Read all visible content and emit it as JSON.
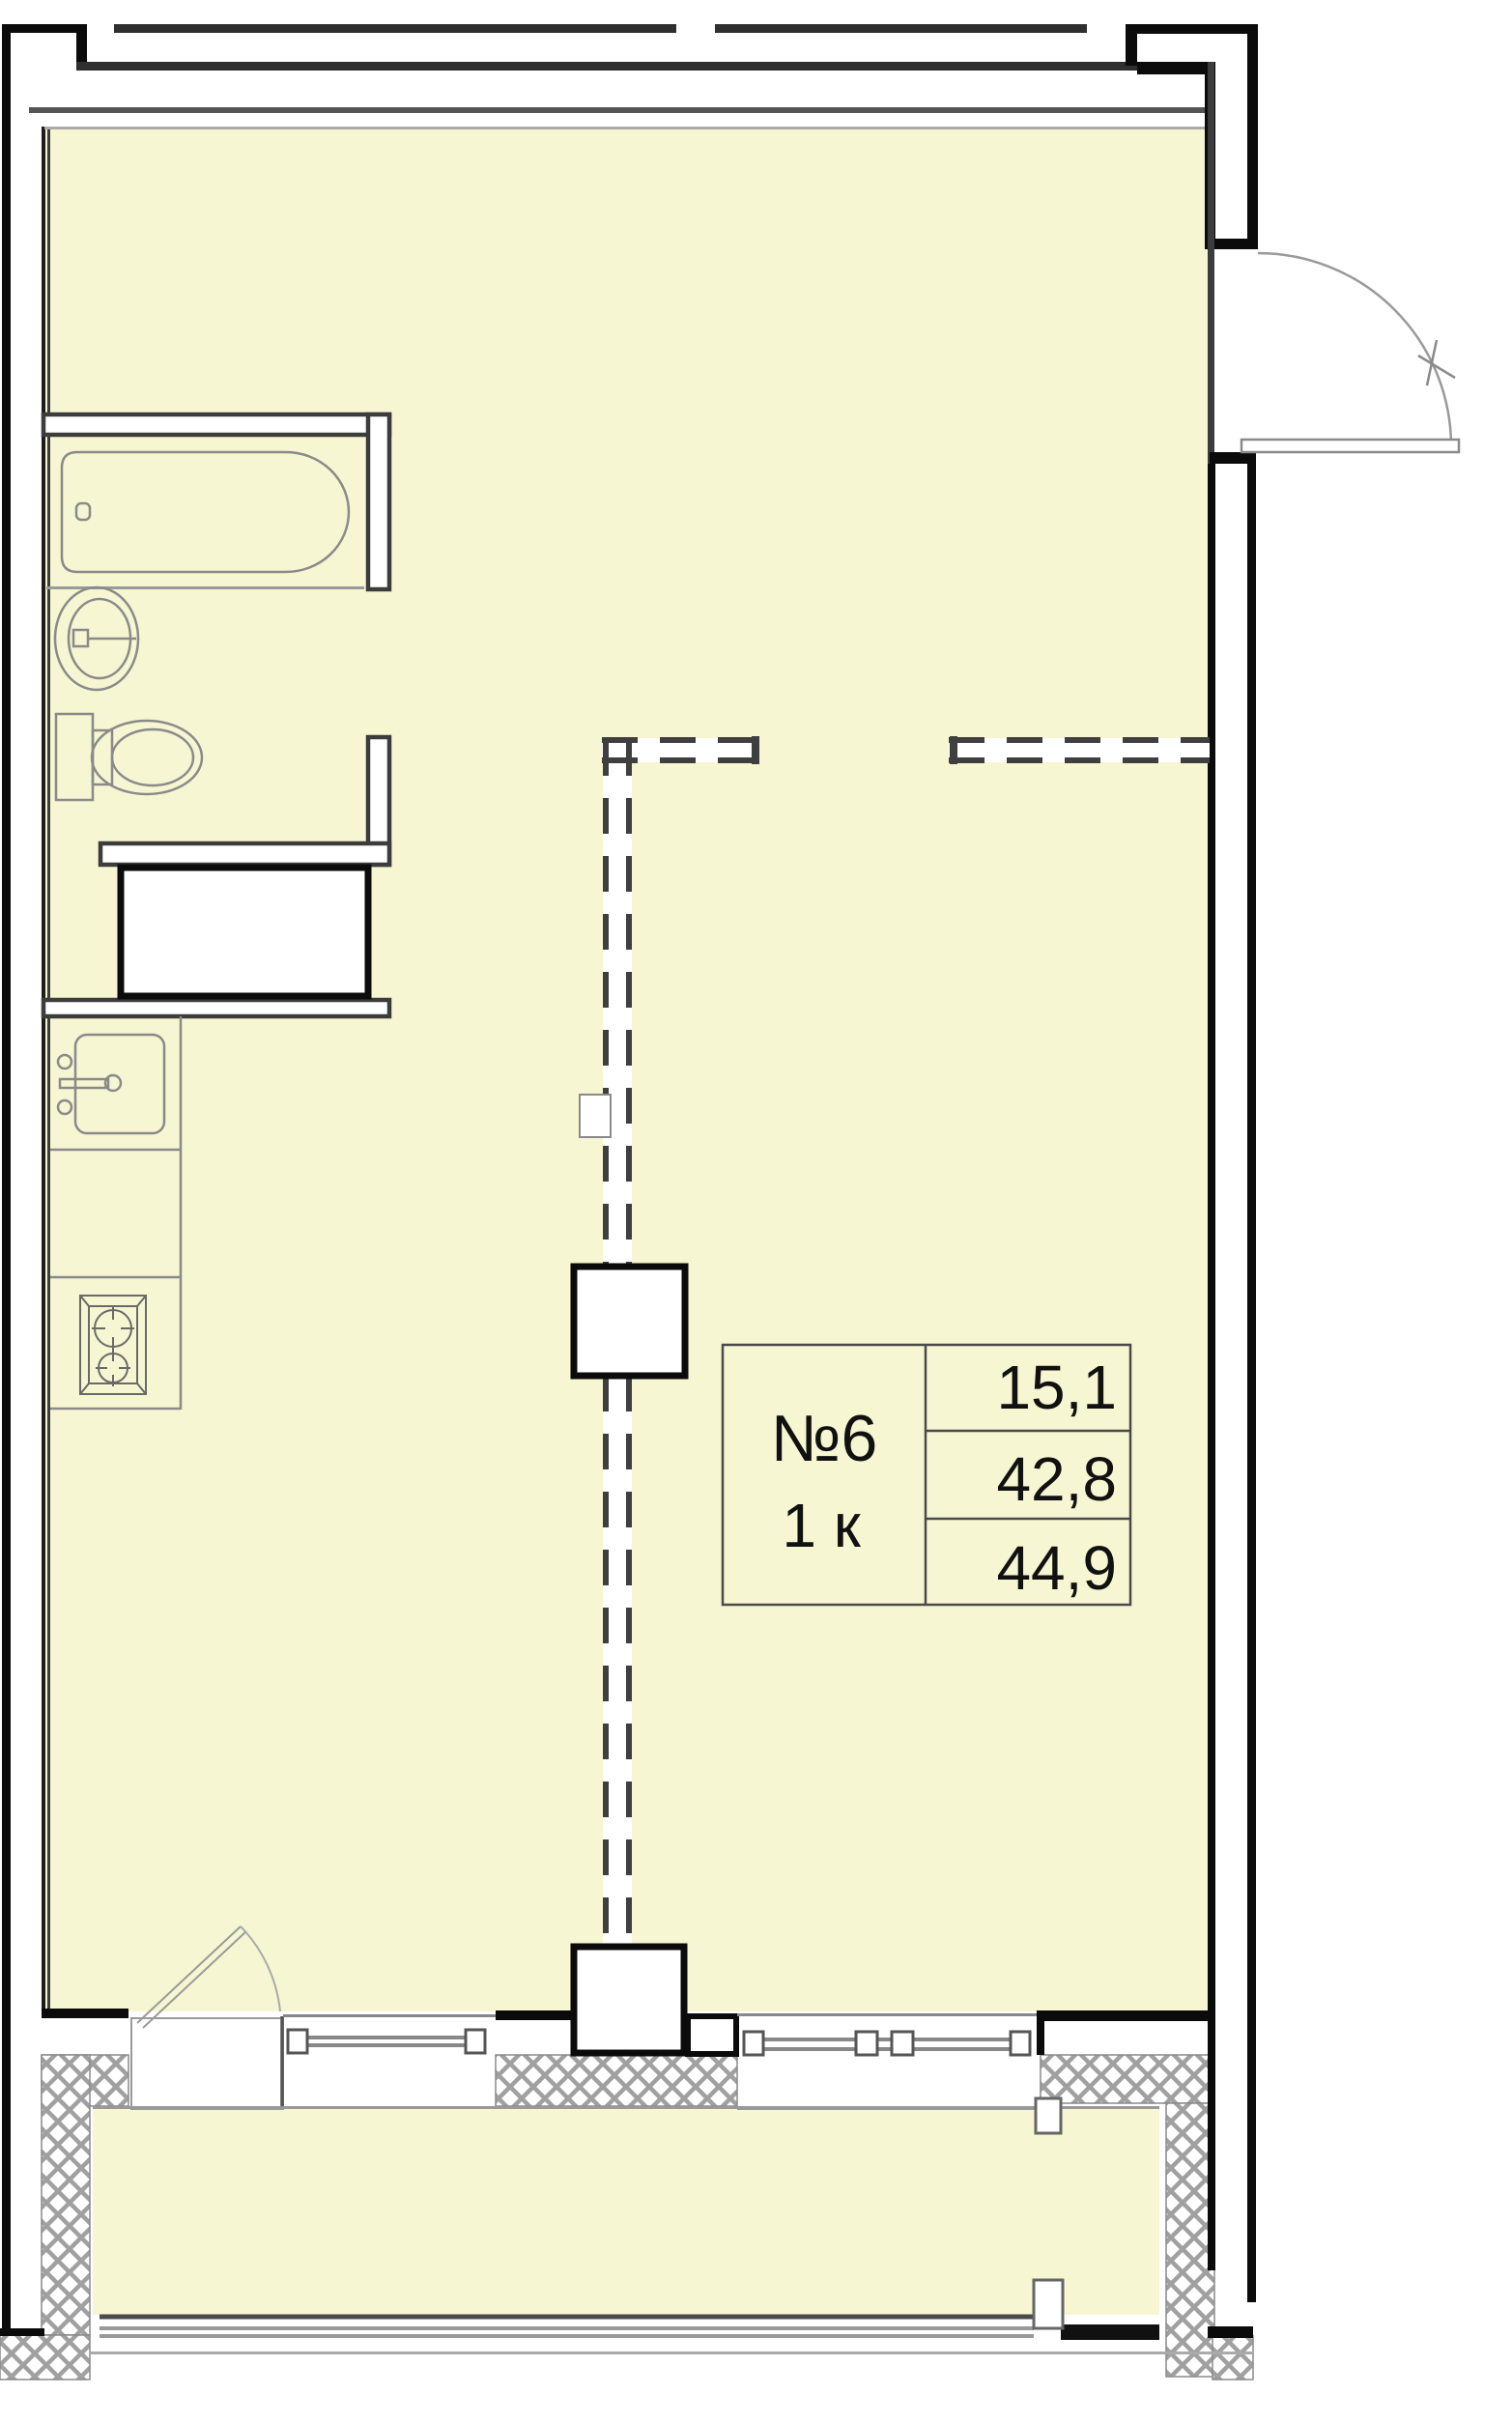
{
  "unit": {
    "number": "№6",
    "rooms": "1 к",
    "area_living": "15,1",
    "area_total": "42,8",
    "area_overall": "44,9"
  },
  "colors": {
    "floor": "#f6f6d2",
    "wall_black": "#0b0b0b",
    "wall_dark": "#3c3c3c",
    "fixture_gray": "#8a8a8a",
    "hatch_gray": "#a0a0a0",
    "label_border": "#4a4a4a",
    "text": "#111111"
  }
}
